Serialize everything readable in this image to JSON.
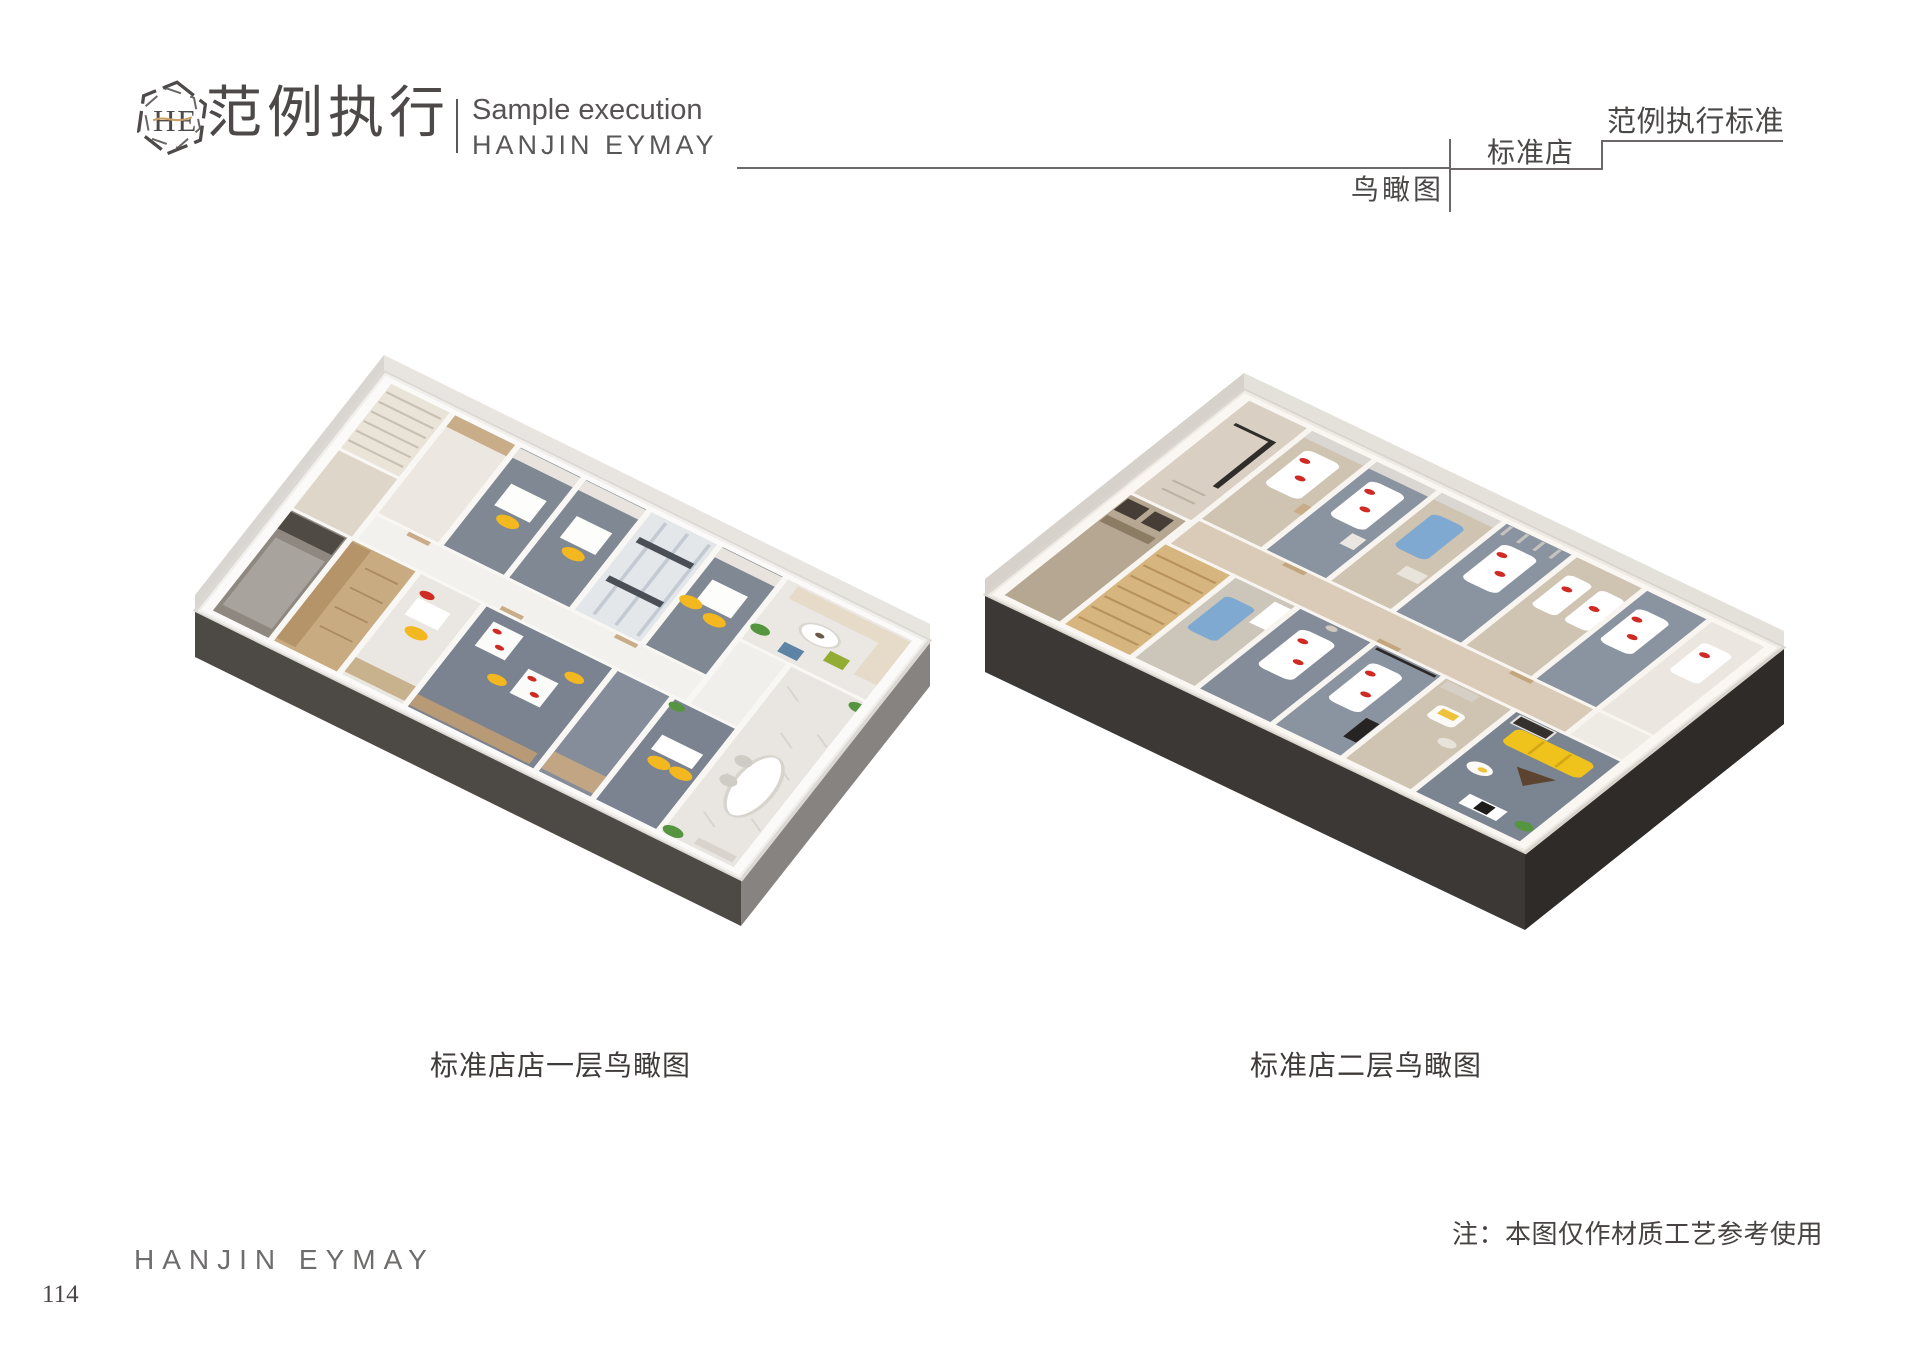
{
  "header": {
    "logo_monogram": "HE",
    "title_cn": "范例执行",
    "subtitle_en": "Sample execution",
    "brand": "HANJIN EYMAY",
    "birdseye_label": "鸟瞰图",
    "store_type_label": "标准店",
    "standard_label": "范例执行标准"
  },
  "figures": [
    {
      "id": "first-floor",
      "caption": "标准店店一层鸟瞰图"
    },
    {
      "id": "second-floor",
      "caption": "标准店二层鸟瞰图"
    }
  ],
  "footer": {
    "note": "注：本图仅作材质工艺参考使用",
    "brand": "HANJIN EYMAY",
    "page_number": "114"
  },
  "colors": {
    "accent_gold": "#c9a063",
    "heading_text": "#4a4747",
    "rule_line": "#6b6867",
    "carpet_gray": "#7f8893",
    "wood_tan": "#c9ab82",
    "chair_yellow": "#f3b71f",
    "sofa_yellow": "#efc31c",
    "accent_red": "#cf2b24",
    "bed_blue": "#7fa9d0",
    "plinth_dark_left": "#4d4945",
    "plinth_dark_right": "#2e2b29"
  }
}
